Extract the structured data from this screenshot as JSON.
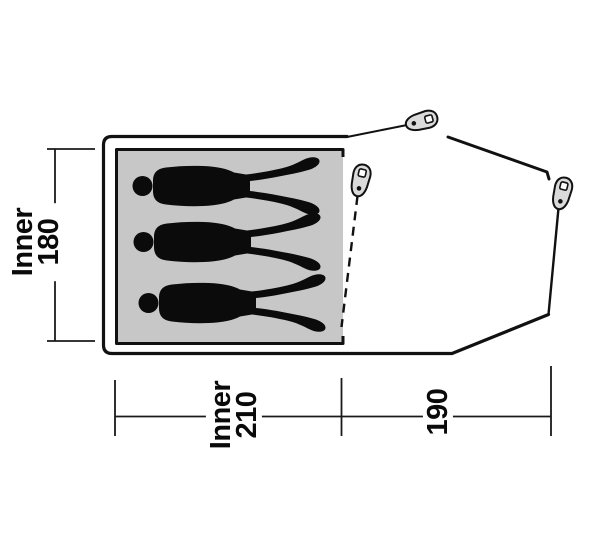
{
  "diagram": {
    "type": "tent-floorplan-top-view",
    "occupant_silhouettes": 3,
    "peg_icons": 3,
    "dimensions": {
      "inner_width": {
        "label": "Inner",
        "value": "180"
      },
      "inner_length": {
        "label": "Inner",
        "value": "210"
      },
      "vestibule_length": {
        "value": "190"
      }
    },
    "colors": {
      "outline": "#111111",
      "inner_floor_fill": "#c7c7c7",
      "silhouette": "#0b0b0b",
      "peg_fill": "#dadada",
      "background": "#ffffff"
    }
  }
}
